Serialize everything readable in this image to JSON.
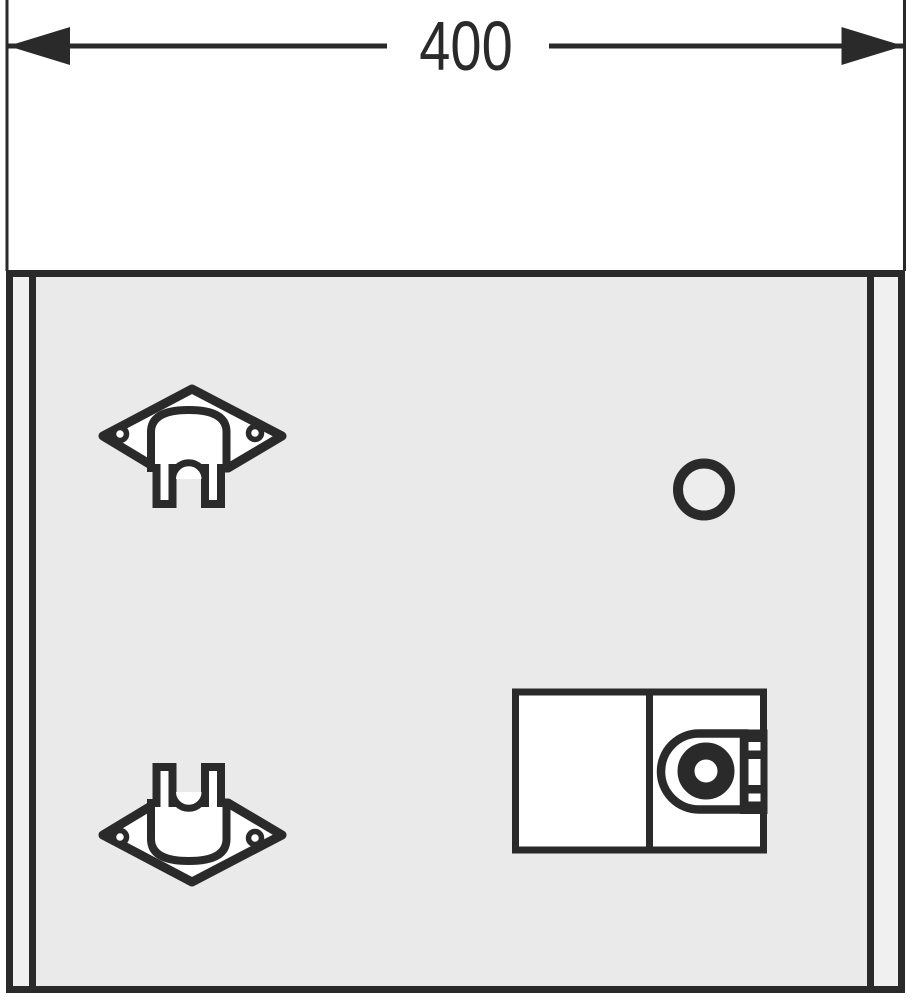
{
  "diagram": {
    "dimension": {
      "label": "400"
    },
    "colors": {
      "line": "#2a2a2a",
      "panel": "#eaeaea",
      "part": "#ffffff",
      "bg": "#ffffff",
      "hole": "#ededed",
      "strip": "#f0f0f0"
    },
    "parts": {
      "panel": "front-access-panel",
      "bracket_top": "diamond-wall-bracket-with-hook",
      "bracket_bottom": "diamond-wall-bracket-with-hook",
      "hole": "round-hole",
      "lock": "lock-unit-with-cylinder"
    }
  }
}
